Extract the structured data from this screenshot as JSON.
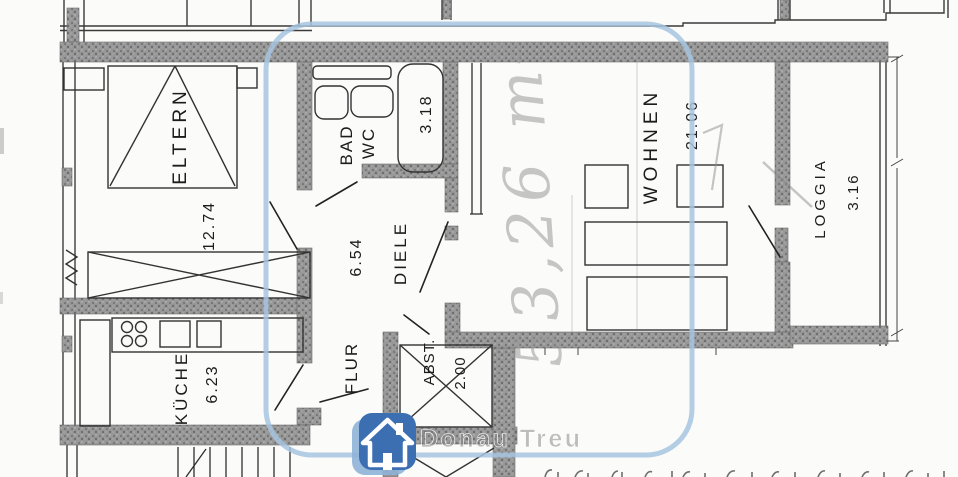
{
  "plan": {
    "rooms": [
      {
        "label": "ELTERN",
        "area": "12.74"
      },
      {
        "label": "BAD",
        "area": ""
      },
      {
        "label": "WC",
        "area": "3.18"
      },
      {
        "label": "DIELE",
        "area": "6.54"
      },
      {
        "label": "FLUR",
        "area": ""
      },
      {
        "label": "ABST.",
        "area": "2.00"
      },
      {
        "label": "KÜCHE",
        "area": "6.23"
      },
      {
        "label": "WOHNEN",
        "area": "21.06"
      },
      {
        "label": "LOGGIA",
        "area": "3.16"
      }
    ],
    "handwritten_note": "53,26 m²"
  },
  "watermark": {
    "text": "Donau Treu",
    "logo": "house-icon"
  },
  "colors": {
    "highlight_outline": "#a6c4e0",
    "logo_blue": "#3c6fb2",
    "logo_blue_light": "#8fb2d8",
    "wall_gray": "#969696"
  }
}
